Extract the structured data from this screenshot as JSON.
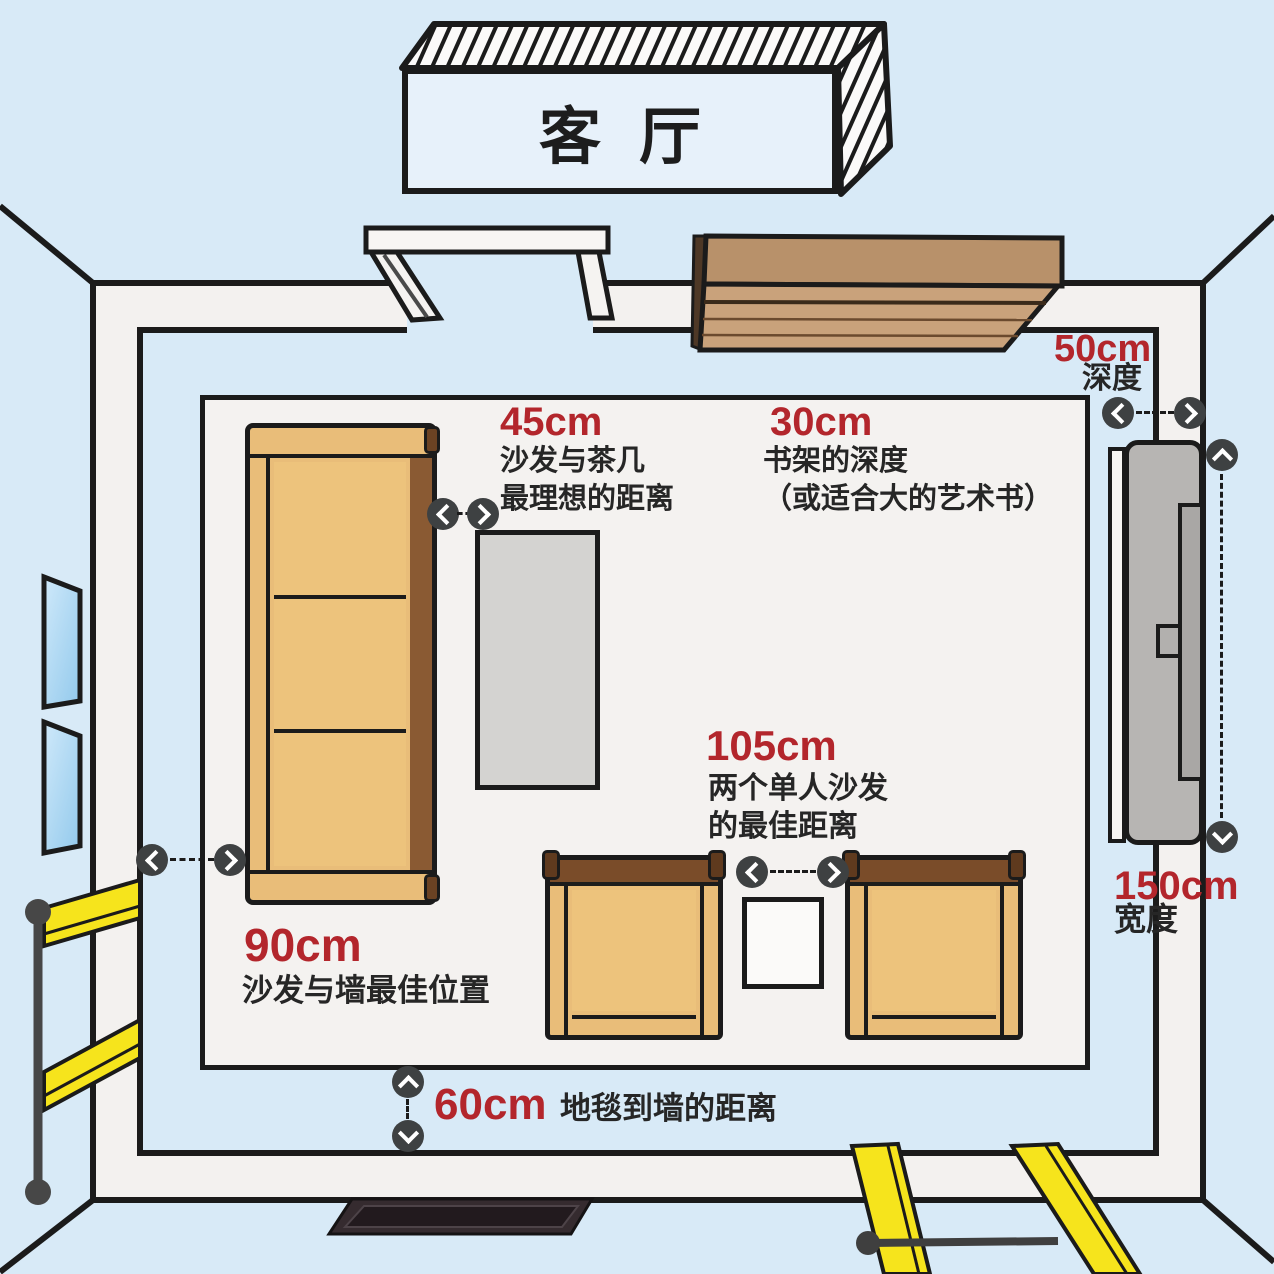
{
  "sign": {
    "title": "客厅"
  },
  "annotations": {
    "sofa_coffee_table": {
      "value": "45cm",
      "line1": "沙发与茶几",
      "line2": "最理想的距离"
    },
    "bookshelf_depth": {
      "value": "30cm",
      "line1": "书架的深度",
      "line2": "（或适合大的艺术书）"
    },
    "single_sofa_gap": {
      "value": "105cm",
      "line1": "两个单人沙发",
      "line2": "的最佳距离"
    },
    "sofa_to_wall": {
      "value": "90cm",
      "line1": "沙发与墙最佳位置"
    },
    "carpet_to_wall": {
      "value": "60cm",
      "line1": "地毯到墙的距离"
    },
    "cabinet_depth": {
      "value": "50cm",
      "line1": "深度"
    },
    "cabinet_width": {
      "value": "150cm",
      "line1": "宽度"
    }
  },
  "colors": {
    "background_blue": "#d8eaf7",
    "wall_white": "#f3f1ef",
    "outline_black": "#1b1b1b",
    "accent_red": "#b3262c",
    "furniture_tan": "#e9bd79",
    "furniture_brown": "#7a4c29",
    "coffee_table_gray": "#d4d3d1",
    "tv_gray": "#b7b5b3",
    "window_blue": "#aed6f1",
    "stripe_yellow": "#f6e41c",
    "marker_gray": "#3e4142"
  }
}
